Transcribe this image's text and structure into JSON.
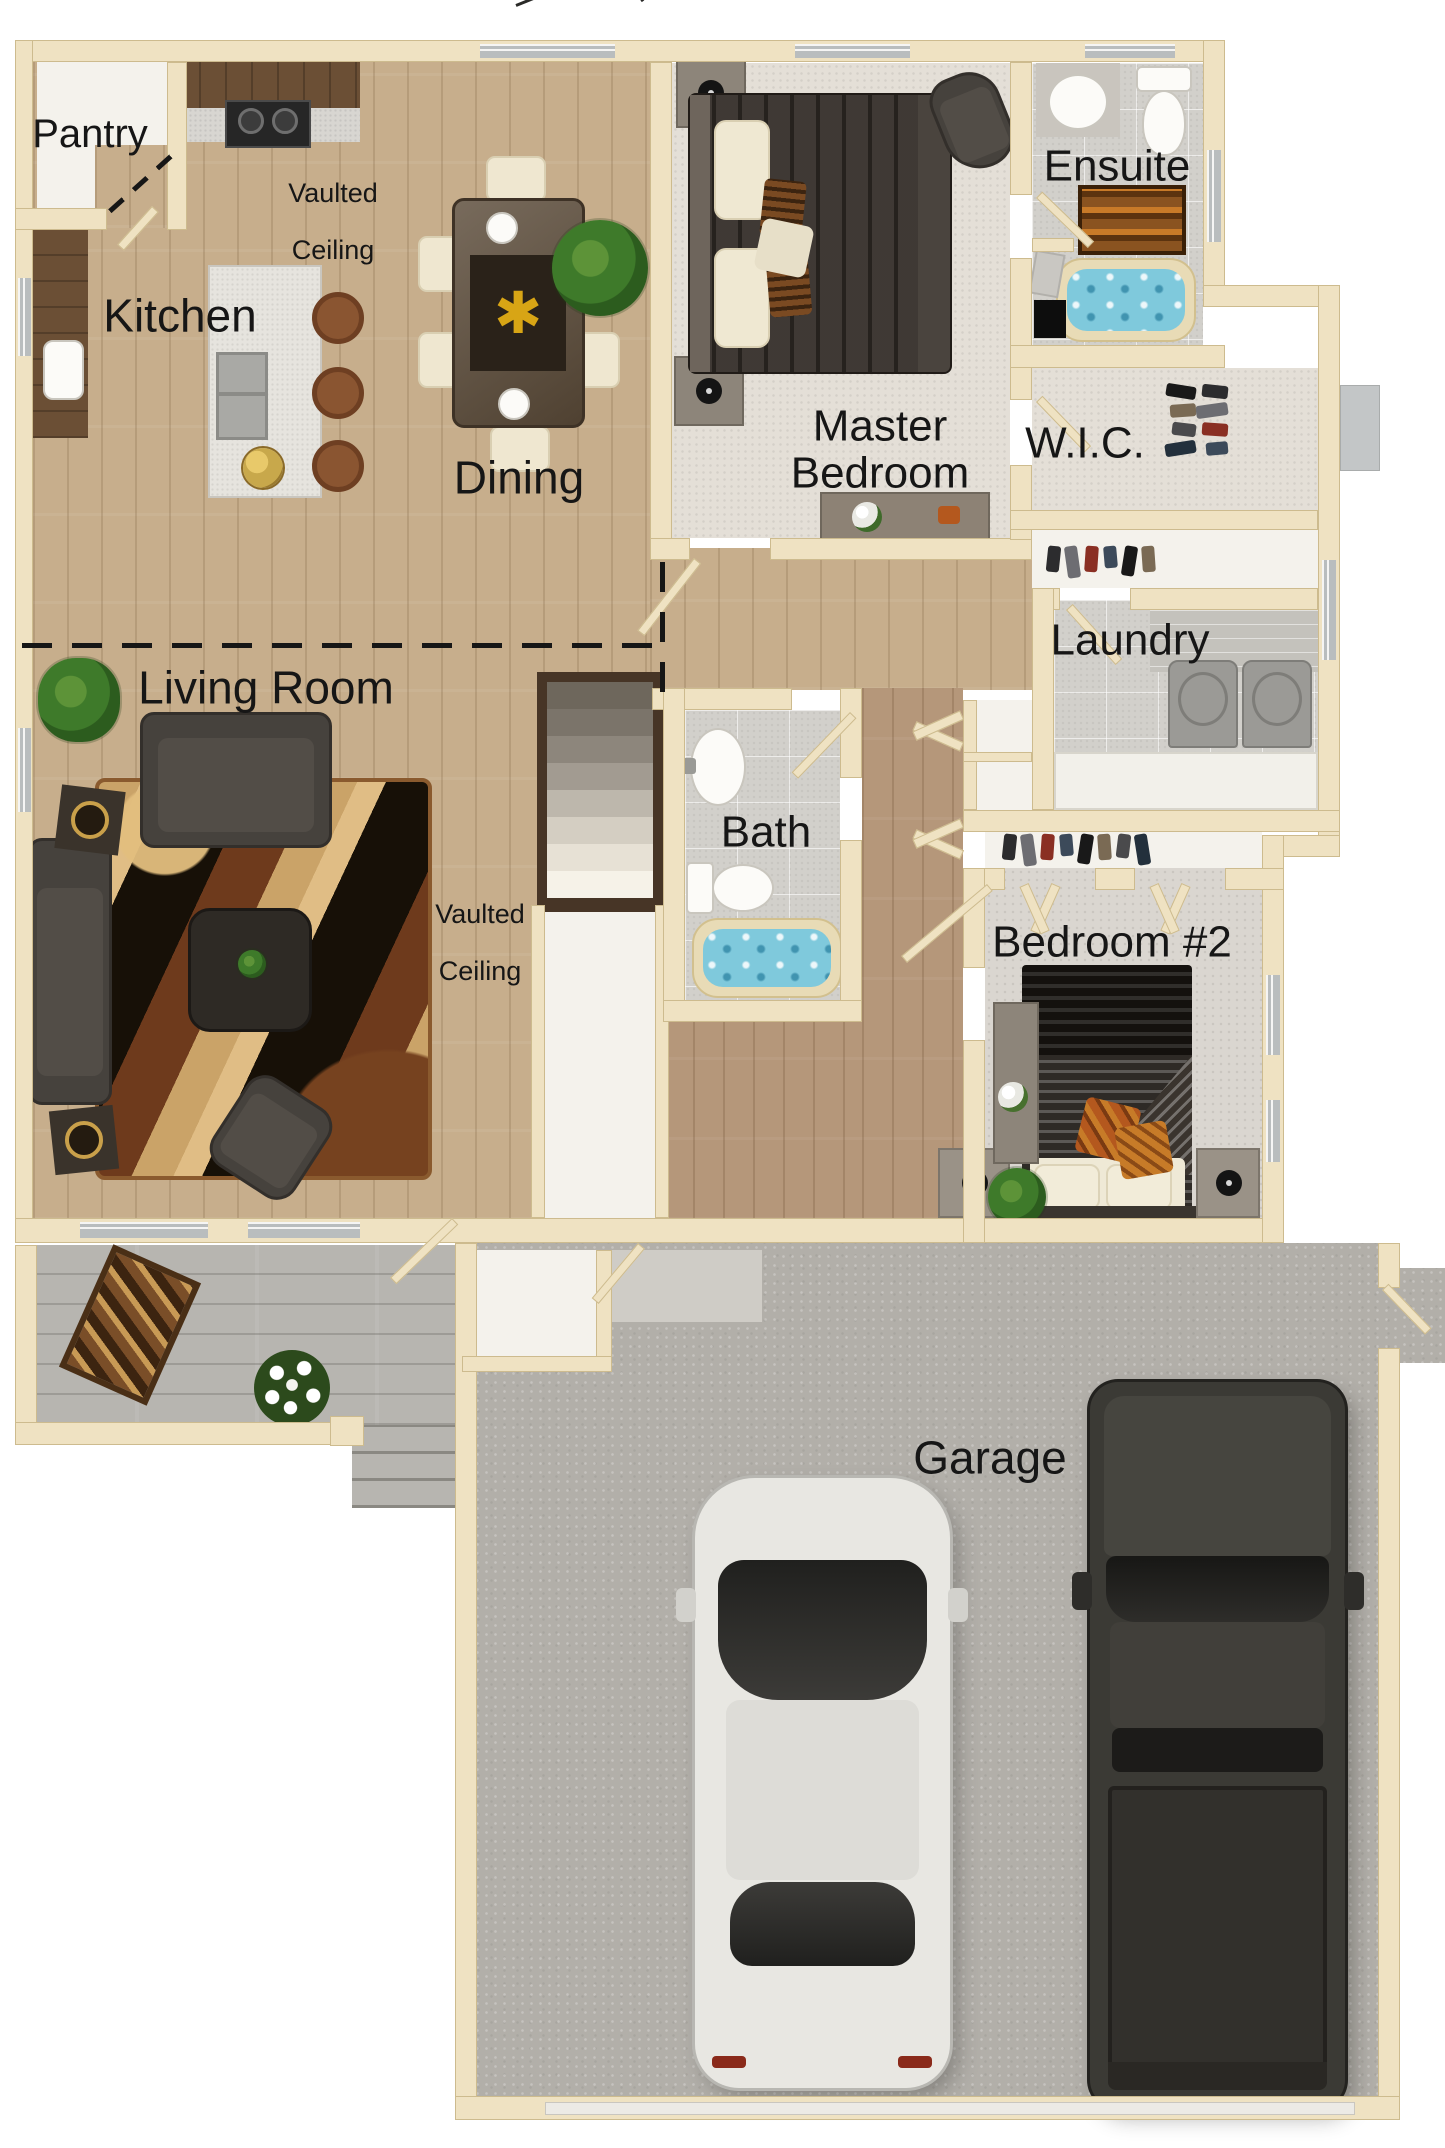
{
  "image_type": "floor-plan-render",
  "rooms": {
    "pantry": {
      "label": "Pantry"
    },
    "kitchen": {
      "label": "Kitchen"
    },
    "dining": {
      "label": "Dining"
    },
    "living_room": {
      "label": "Living Room"
    },
    "master_bedroom": {
      "line1": "Master",
      "line2": "Bedroom"
    },
    "ensuite": {
      "label": "Ensuite"
    },
    "wic": {
      "label": "W.I.C."
    },
    "laundry": {
      "label": "Laundry"
    },
    "bath": {
      "label": "Bath"
    },
    "bedroom2": {
      "label": "Bedroom #2"
    },
    "garage": {
      "label": "Garage"
    }
  },
  "annotations": {
    "vaulted_ceiling": {
      "line1": "Vaulted",
      "line2": "Ceiling"
    }
  },
  "colors": {
    "wall": "#efe2c2",
    "wall_edge": "#cdbb8e",
    "wood": "#c7ae8c",
    "wood_dark": "#b5977a",
    "carpet_master": "#e4dfd7",
    "carpet_bed2": "#dad6d0",
    "tile": "#d2d0cb",
    "deck": "#b7b5b0",
    "concrete": "#b2afa9",
    "water": "#7fc9dc",
    "text": "#161616"
  }
}
